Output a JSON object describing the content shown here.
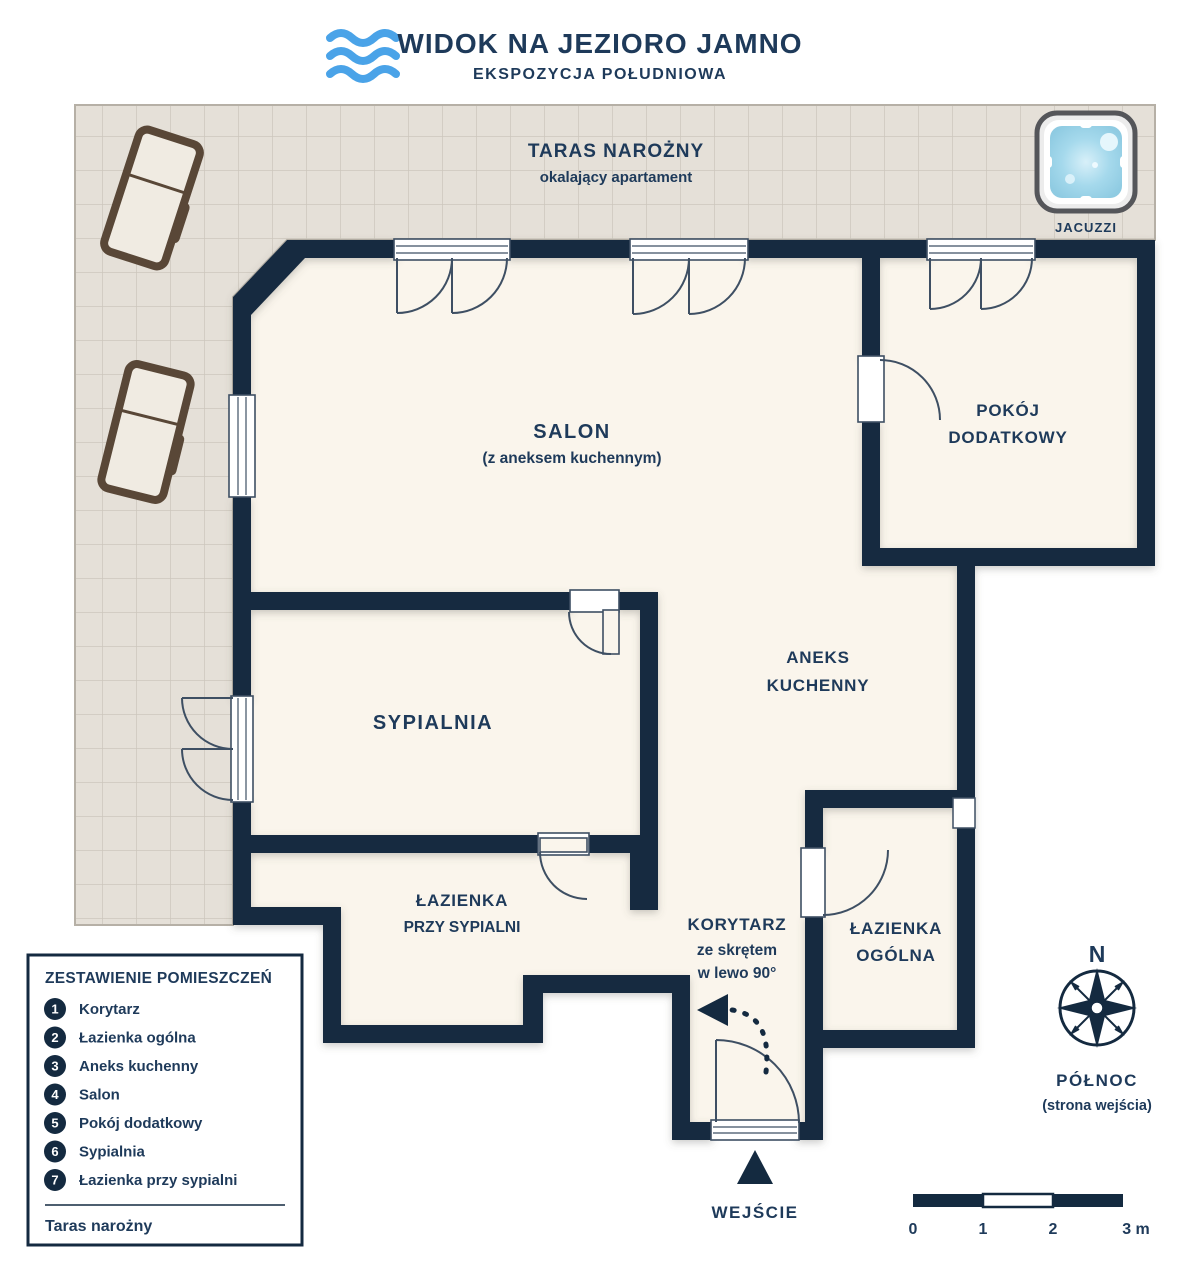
{
  "header": {
    "title": "WIDOK NA JEZIORO JAMNO",
    "subtitle": "EKSPOZYCJA POŁUDNIOWA",
    "logo_icon": "waves-icon"
  },
  "terrace": {
    "title": "TARAS NAROŻNY",
    "subtitle": "okalający apartament",
    "jacuzzi_label": "JACUZZI"
  },
  "rooms": {
    "salon": {
      "name": "SALON",
      "note": "(z aneksem kuchennym)"
    },
    "pokoj_dodatkowy": {
      "line1": "POKÓJ",
      "line2": "DODATKOWY"
    },
    "aneks_kuchenny": {
      "line1": "ANEKS",
      "line2": "KUCHENNY"
    },
    "sypialnia": {
      "name": "SYPIALNIA"
    },
    "lazienka_przy_sypialni": {
      "line1": "ŁAZIENKA",
      "line2": "PRZY SYPIALNI"
    },
    "korytarz": {
      "line1": "KORYTARZ",
      "line2": "ze skrętem",
      "line3": "w lewo 90°"
    },
    "lazienka_ogolna": {
      "line1": "ŁAZIENKA",
      "line2": "OGÓLNA"
    }
  },
  "entrance": {
    "label": "WEJŚCIE"
  },
  "legend": {
    "title": "ZESTAWIENIE POMIESZCZEŃ",
    "items": [
      {
        "num": "1",
        "label": "Korytarz"
      },
      {
        "num": "2",
        "label": "Łazienka ogólna"
      },
      {
        "num": "3",
        "label": "Aneks kuchenny"
      },
      {
        "num": "4",
        "label": "Salon"
      },
      {
        "num": "5",
        "label": "Pokój dodatkowy"
      },
      {
        "num": "6",
        "label": "Sypialnia"
      },
      {
        "num": "7",
        "label": "Łazienka przy sypialni"
      }
    ],
    "footer": "Taras narożny"
  },
  "compass": {
    "n": "N",
    "direction": "PÓŁNOC",
    "note": "(strona wejścia)"
  },
  "scale_bar": {
    "ticks": [
      "0",
      "1",
      "2",
      "3 m"
    ]
  },
  "colors": {
    "wall": "#142a40",
    "label_text": "#1e3a5a",
    "wave_blue": "#4aa3e8",
    "floor": "#faf5ec",
    "terrace_tile": "#e5e0d8",
    "jacuzzi_water": "#9fd4e8"
  }
}
